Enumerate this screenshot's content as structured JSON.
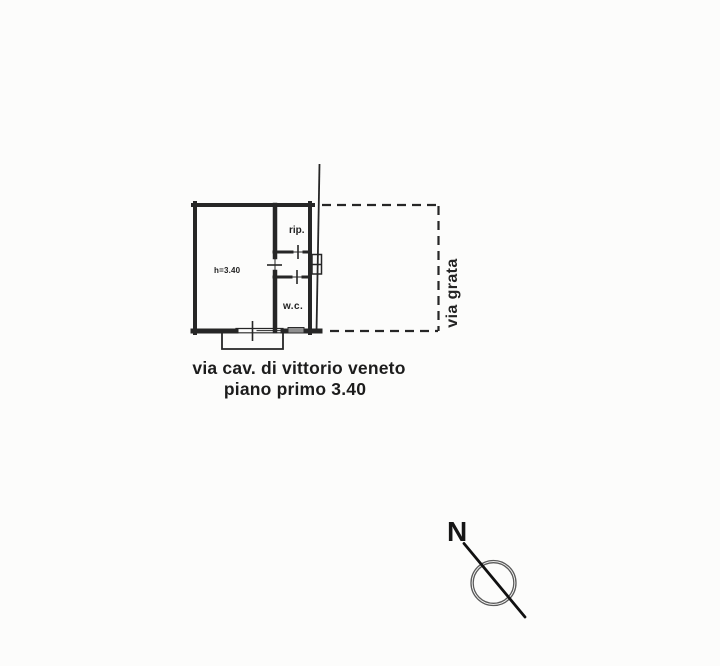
{
  "page": {
    "background": "#fcfcfb",
    "ink": "#262626"
  },
  "plan": {
    "labels": {
      "room_height": "h=3.40",
      "storage": "rip.",
      "wc": "w.c."
    },
    "street_side_label": "via grata",
    "captions": {
      "line1": "via cav. di vittorio veneto",
      "line2": "piano primo 3.40"
    },
    "compass": {
      "north_label": "N"
    }
  }
}
